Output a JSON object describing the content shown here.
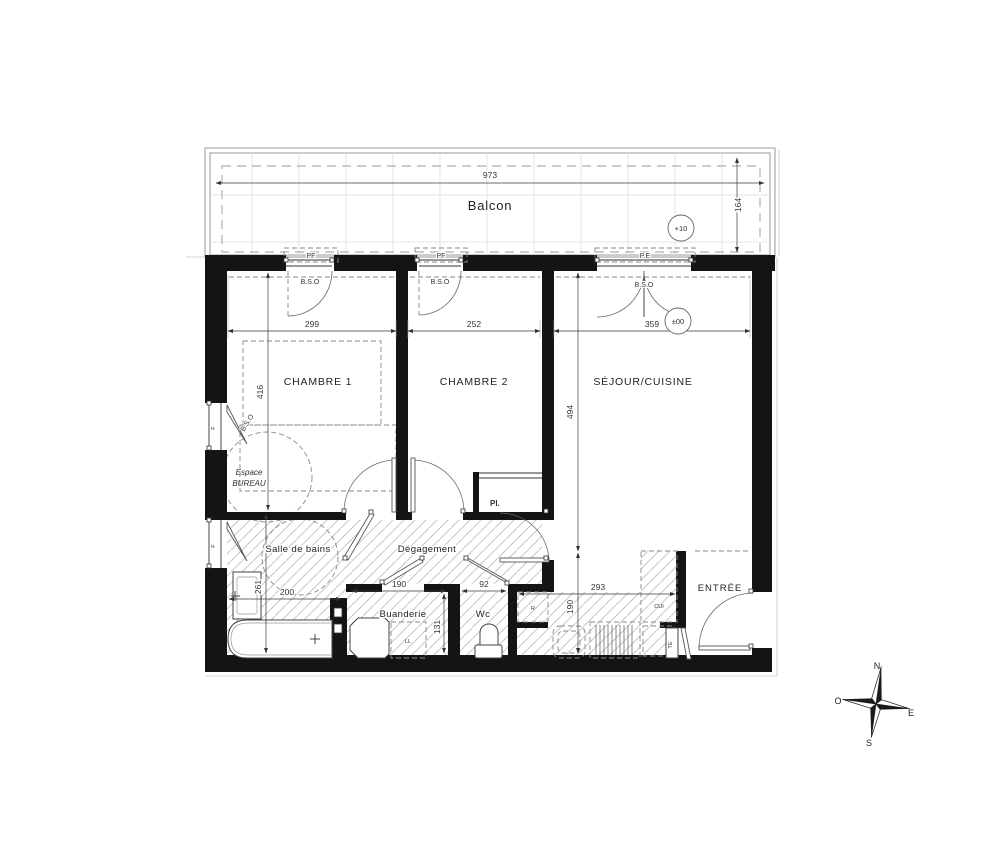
{
  "rooms": {
    "balcon": "Balcon",
    "chambre1": "CHAMBRE 1",
    "chambre2": "CHAMBRE 2",
    "sejour": "SÉJOUR/CUISINE",
    "salle_de_bains": "Salle de bains",
    "degagement": "Dégagement",
    "buanderie": "Buanderie",
    "wc": "Wc",
    "entree": "ENTRÉE"
  },
  "annotations": {
    "espace_line1": "Espace",
    "espace_line2": "BUREAU",
    "placard": "Pl.",
    "lave_linge": "LL",
    "refrigerateur": "R",
    "cuisine": "CUI",
    "tableau_electrique": "TE",
    "porte_fenetre": "PF",
    "porte_entree": "P.E",
    "bso": "B.S.O",
    "fenetre": "F"
  },
  "levels": {
    "balcon": "+10",
    "logement": "±00"
  },
  "dimensions": {
    "balcon_largeur": "973",
    "balcon_profondeur": "164",
    "chambre1_largeur": "299",
    "chambre2_largeur": "252",
    "sejour_largeur": "359",
    "chambre1_profondeur": "416",
    "sejour_profondeur": "494",
    "sdb_largeur": "200",
    "sdb_profondeur": "261",
    "buanderie_largeur": "190",
    "buanderie_profondeur": "131",
    "wc_largeur": "92",
    "cuisine_largeur": "293",
    "cuisine_profondeur": "190"
  },
  "compass": {
    "n": "N",
    "s": "S",
    "e": "E",
    "o": "O"
  }
}
